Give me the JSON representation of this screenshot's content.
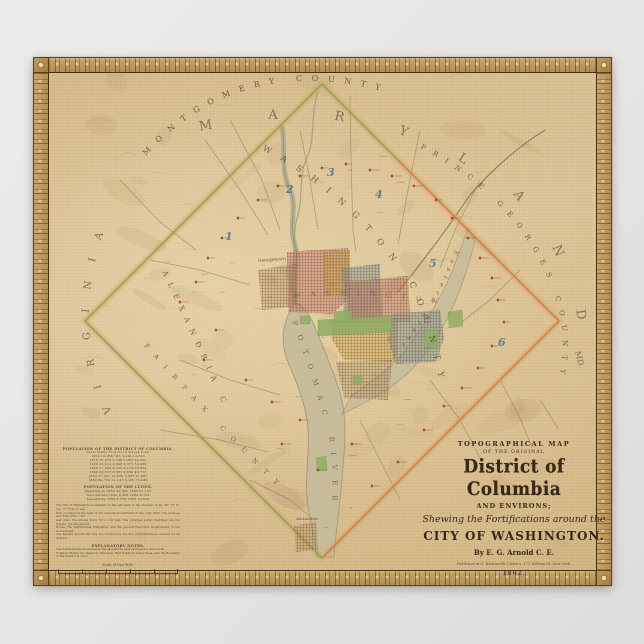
{
  "title_block": {
    "kicker": "TOPOGRAPHICAL MAP",
    "subkicker": "OF THE ORIGINAL",
    "main_title": "District of Columbia",
    "environs": "AND ENVIRONS;",
    "shewing": "Shewing the Fortifications around the",
    "city_line": "CITY OF WASHINGTON.",
    "byline": "By E. G. Arnold C. E.",
    "publisher": "Published at G. Woolworth Colton's, 172 William St. New York.",
    "year": "1862."
  },
  "stats": {
    "table1_title": "POPULATION OF THE DISTRICT OF COLUMBIA.",
    "table1_head": "Years    White    Free Col'd    Slaves    Total",
    "table1_rows": [
      "1800   10,066    783    3,244   14,093",
      "1810   16,079   2,549   5,395   24,023",
      "1820   22,614   4,048   6,377   33,039",
      "1830   27,563   6,152   6,119   39,834",
      "1840   30,657   8,361   4,694   43,712",
      "1850   37,941  10,059   3,687   51,687",
      "1860   60,764  11,131   3,185   75,080"
    ],
    "table2_title": "POPULATION OF THE CITIES.",
    "table2_rows": [
      "Washington   1850  40,001    1860  61,122",
      "Georgetown   1850   8,366    1860   8,733",
      "Alexandria   1850   8,734    1860  12,652"
    ],
    "note_lines": [
      "The City of Washington is situated on the left bank of the Potomac in lat. 38° 53′ N., lon. 77° 2′ W.; it was",
      "first occupied as the Seat of the General Government in the year 1800. The avenues are from 120 to 160",
      "feet wide; the streets from 70 to 110 feet. The principal public buildings are the Capitol, the President's",
      "House, the Smithsonian Institution, and the several Executive Departments of the Government.",
      "The heights around the City are crowned by the line of Fortifications erected for its defence."
    ],
    "notes_heading": "EXPLANATORY NOTES.",
    "notes_lines": [
      "The Fortifications are indicated thus ▪ with the name annexed to each work.",
      "Common Roads are shewn by fine lines, Rail Roads by heavy lines, and the Boundary of the District in color."
    ],
    "scale_label": "Scale of One Mile."
  },
  "labels": {
    "montgomery": "MONTGOMERY COUNTY",
    "maryland": "MARYLAND",
    "prince_georges": "PRINCE GEORGES COUNTY",
    "md": "MD.",
    "virginia": "VIRGINIA",
    "fairfax": "FAIRFAX COUNTY",
    "washington_county": "WASHINGTON COUNTY",
    "washington_city": "WASHINGTON",
    "alexandria_county": "ALEXANDRIA CO.",
    "potomac": "POTOMAC RIVER",
    "eastern_branch": "Eastern Branch",
    "georgetown": "Georgetown",
    "alexandria_city": "Alexandria"
  },
  "district_numbers": [
    "1",
    "2",
    "3",
    "4",
    "5",
    "6"
  ],
  "colors": {
    "paper": "#dcc397",
    "border_gold": "#b28d52",
    "ward_pink": "#cd8276",
    "ward_yellow": "#d6af5a",
    "ward_blue": "#8ca09e",
    "park_green": "#8fae66",
    "boundary_green": "#7fae57",
    "boundary_orange": "#d4854a",
    "fort_red": "#9e3318",
    "river": "#c6bc9b",
    "number_blue": "#40708e",
    "ink": "#3a2c18"
  }
}
